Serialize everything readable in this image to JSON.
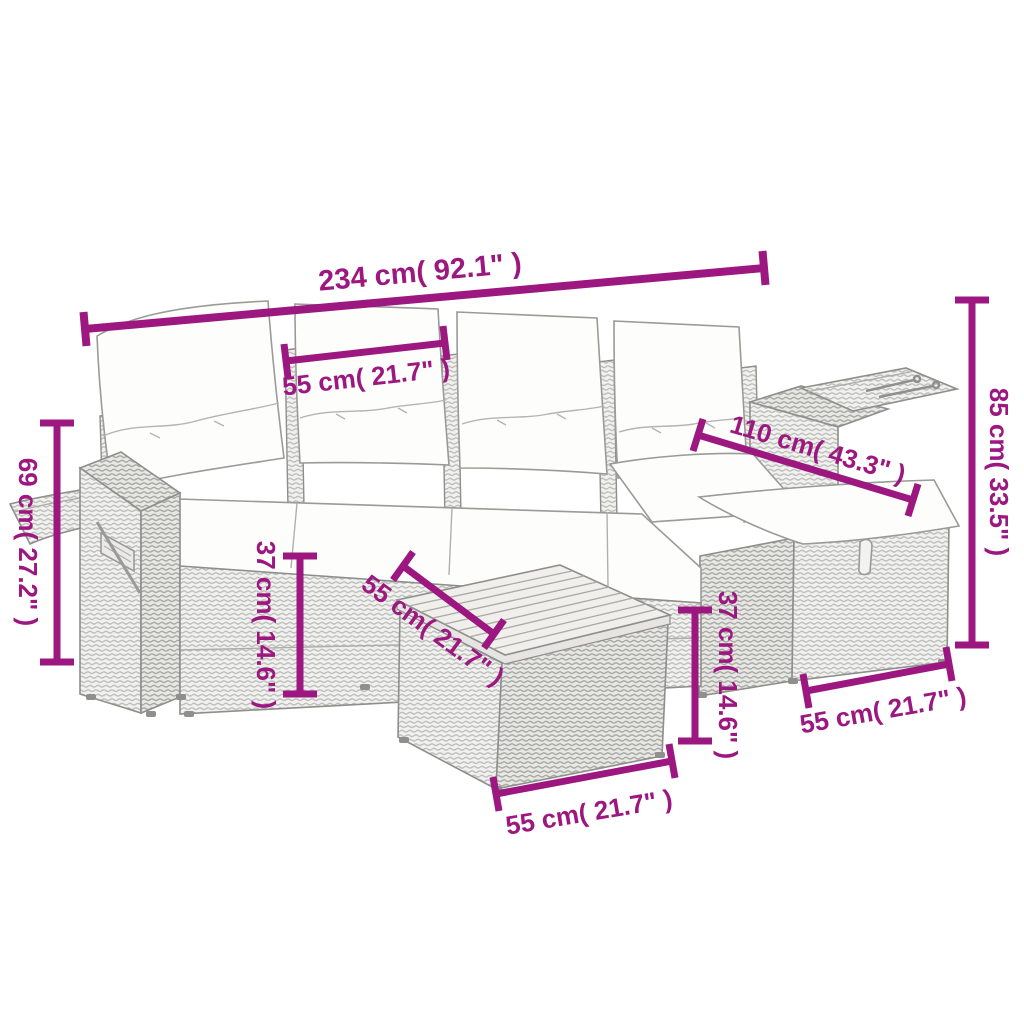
{
  "subject": "L-shaped poly rattan garden sofa set with white back and seat cushions, left arm tray, right arm shelf, slatted wood footstool table and ottoman, annotated with magenta dimension lines",
  "background_color": "#FFFFFF",
  "accent_color": "#9C1880",
  "artwork_line_color": "#8E8E8C",
  "dimensions": [
    {
      "id": "overall-width",
      "text": "234 cm( 92.1\" )"
    },
    {
      "id": "backrest-cushion-width",
      "text": "55 cm( 21.7\" )"
    },
    {
      "id": "overall-height",
      "text": "85 cm( 33.5\" )"
    },
    {
      "id": "chaise-depth",
      "text": "110 cm( 43.3\" )"
    },
    {
      "id": "armrest-height",
      "text": "69 cm( 27.2\" )"
    },
    {
      "id": "seat-height-left",
      "text": "37 cm( 14.6\" )"
    },
    {
      "id": "table-top-width",
      "text": "55 cm( 21.7\" )"
    },
    {
      "id": "seat-height-right",
      "text": "37 cm( 14.6\" )"
    },
    {
      "id": "table-width",
      "text": "55 cm( 21.7\" )"
    },
    {
      "id": "ottoman-width",
      "text": "55 cm( 21.7\" )"
    }
  ]
}
